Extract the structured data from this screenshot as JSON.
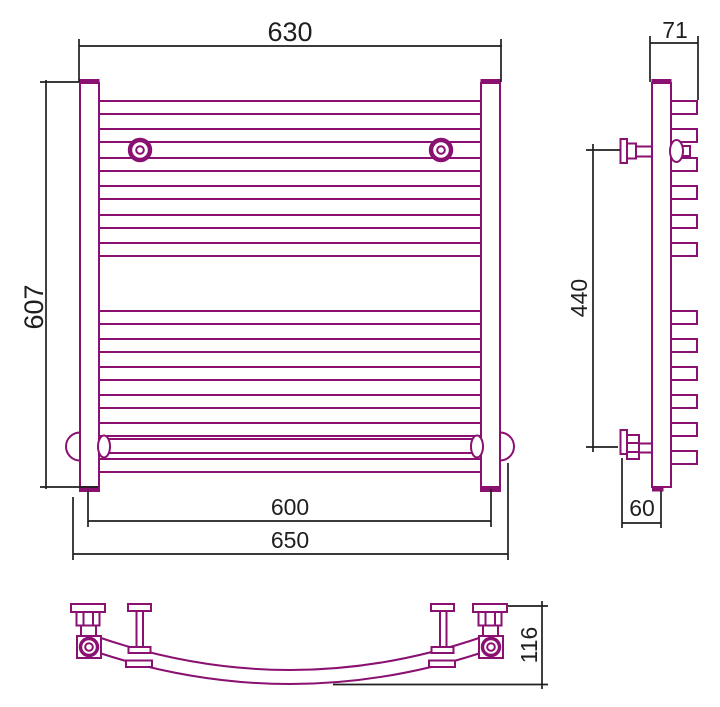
{
  "drawing": {
    "kind": "technical dimension drawing",
    "subject": "curved ladder towel radiator with side wall brackets and corner valves",
    "views": {
      "front": {
        "dims": {
          "width_top": "630",
          "height": "607",
          "width_connections": "600",
          "width_overall": "650"
        }
      },
      "side": {
        "dims": {
          "depth_top": "71",
          "bracket_spacing": "440",
          "wall_offset": "60"
        }
      },
      "bottom": {
        "dims": {
          "depth": "116"
        }
      }
    },
    "colors": {
      "line": "#8A1071",
      "dim_line": "#1f1f1f",
      "background": "#ffffff"
    }
  }
}
